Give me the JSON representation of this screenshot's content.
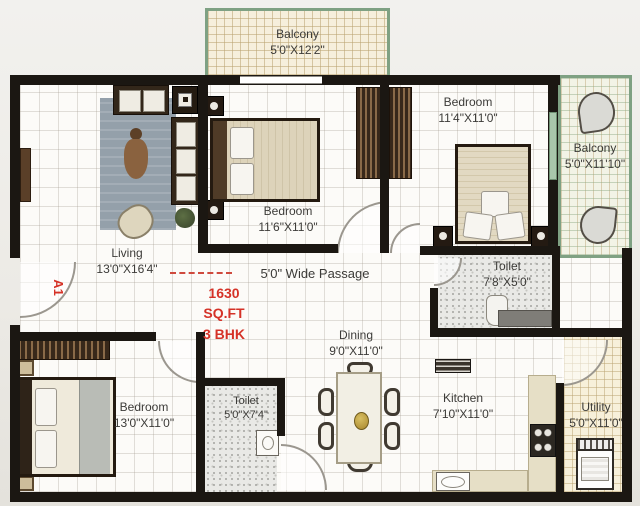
{
  "unit": {
    "code": "A1",
    "area": "1630 SQ.FT",
    "config": "3 BHK"
  },
  "passage": {
    "label": "5'0\" Wide Passage"
  },
  "rooms": {
    "balcony_top": {
      "name": "Balcony",
      "dims": "5'0\"X12'2\""
    },
    "bedroom_top": {
      "name": "Bedroom",
      "dims": "11'4\"X11'0\""
    },
    "balcony_right": {
      "name": "Balcony",
      "dims": "5'0\"X11'10\""
    },
    "bedroom_mid": {
      "name": "Bedroom",
      "dims": "11'6\"X11'0\""
    },
    "living": {
      "name": "Living",
      "dims": "13'0\"X16'4\""
    },
    "toilet_top": {
      "name": "Toilet",
      "dims": "7'8\"X5'0\""
    },
    "dining": {
      "name": "Dining",
      "dims": "9'0\"X11'0\""
    },
    "bedroom_bottom": {
      "name": "Bedroom",
      "dims": "13'0\"X11'0\""
    },
    "toilet_bottom": {
      "name": "Toilet",
      "dims": "5'0\"X7'4\""
    },
    "kitchen": {
      "name": "Kitchen",
      "dims": "7'10\"X11'0\""
    },
    "utility": {
      "name": "Utility",
      "dims": "5'0\"X11'0\""
    }
  },
  "colors": {
    "wall": "#1b1712",
    "accent_red": "#d53227",
    "balcony_green": "#7fa183",
    "label": "#3c3b38"
  }
}
